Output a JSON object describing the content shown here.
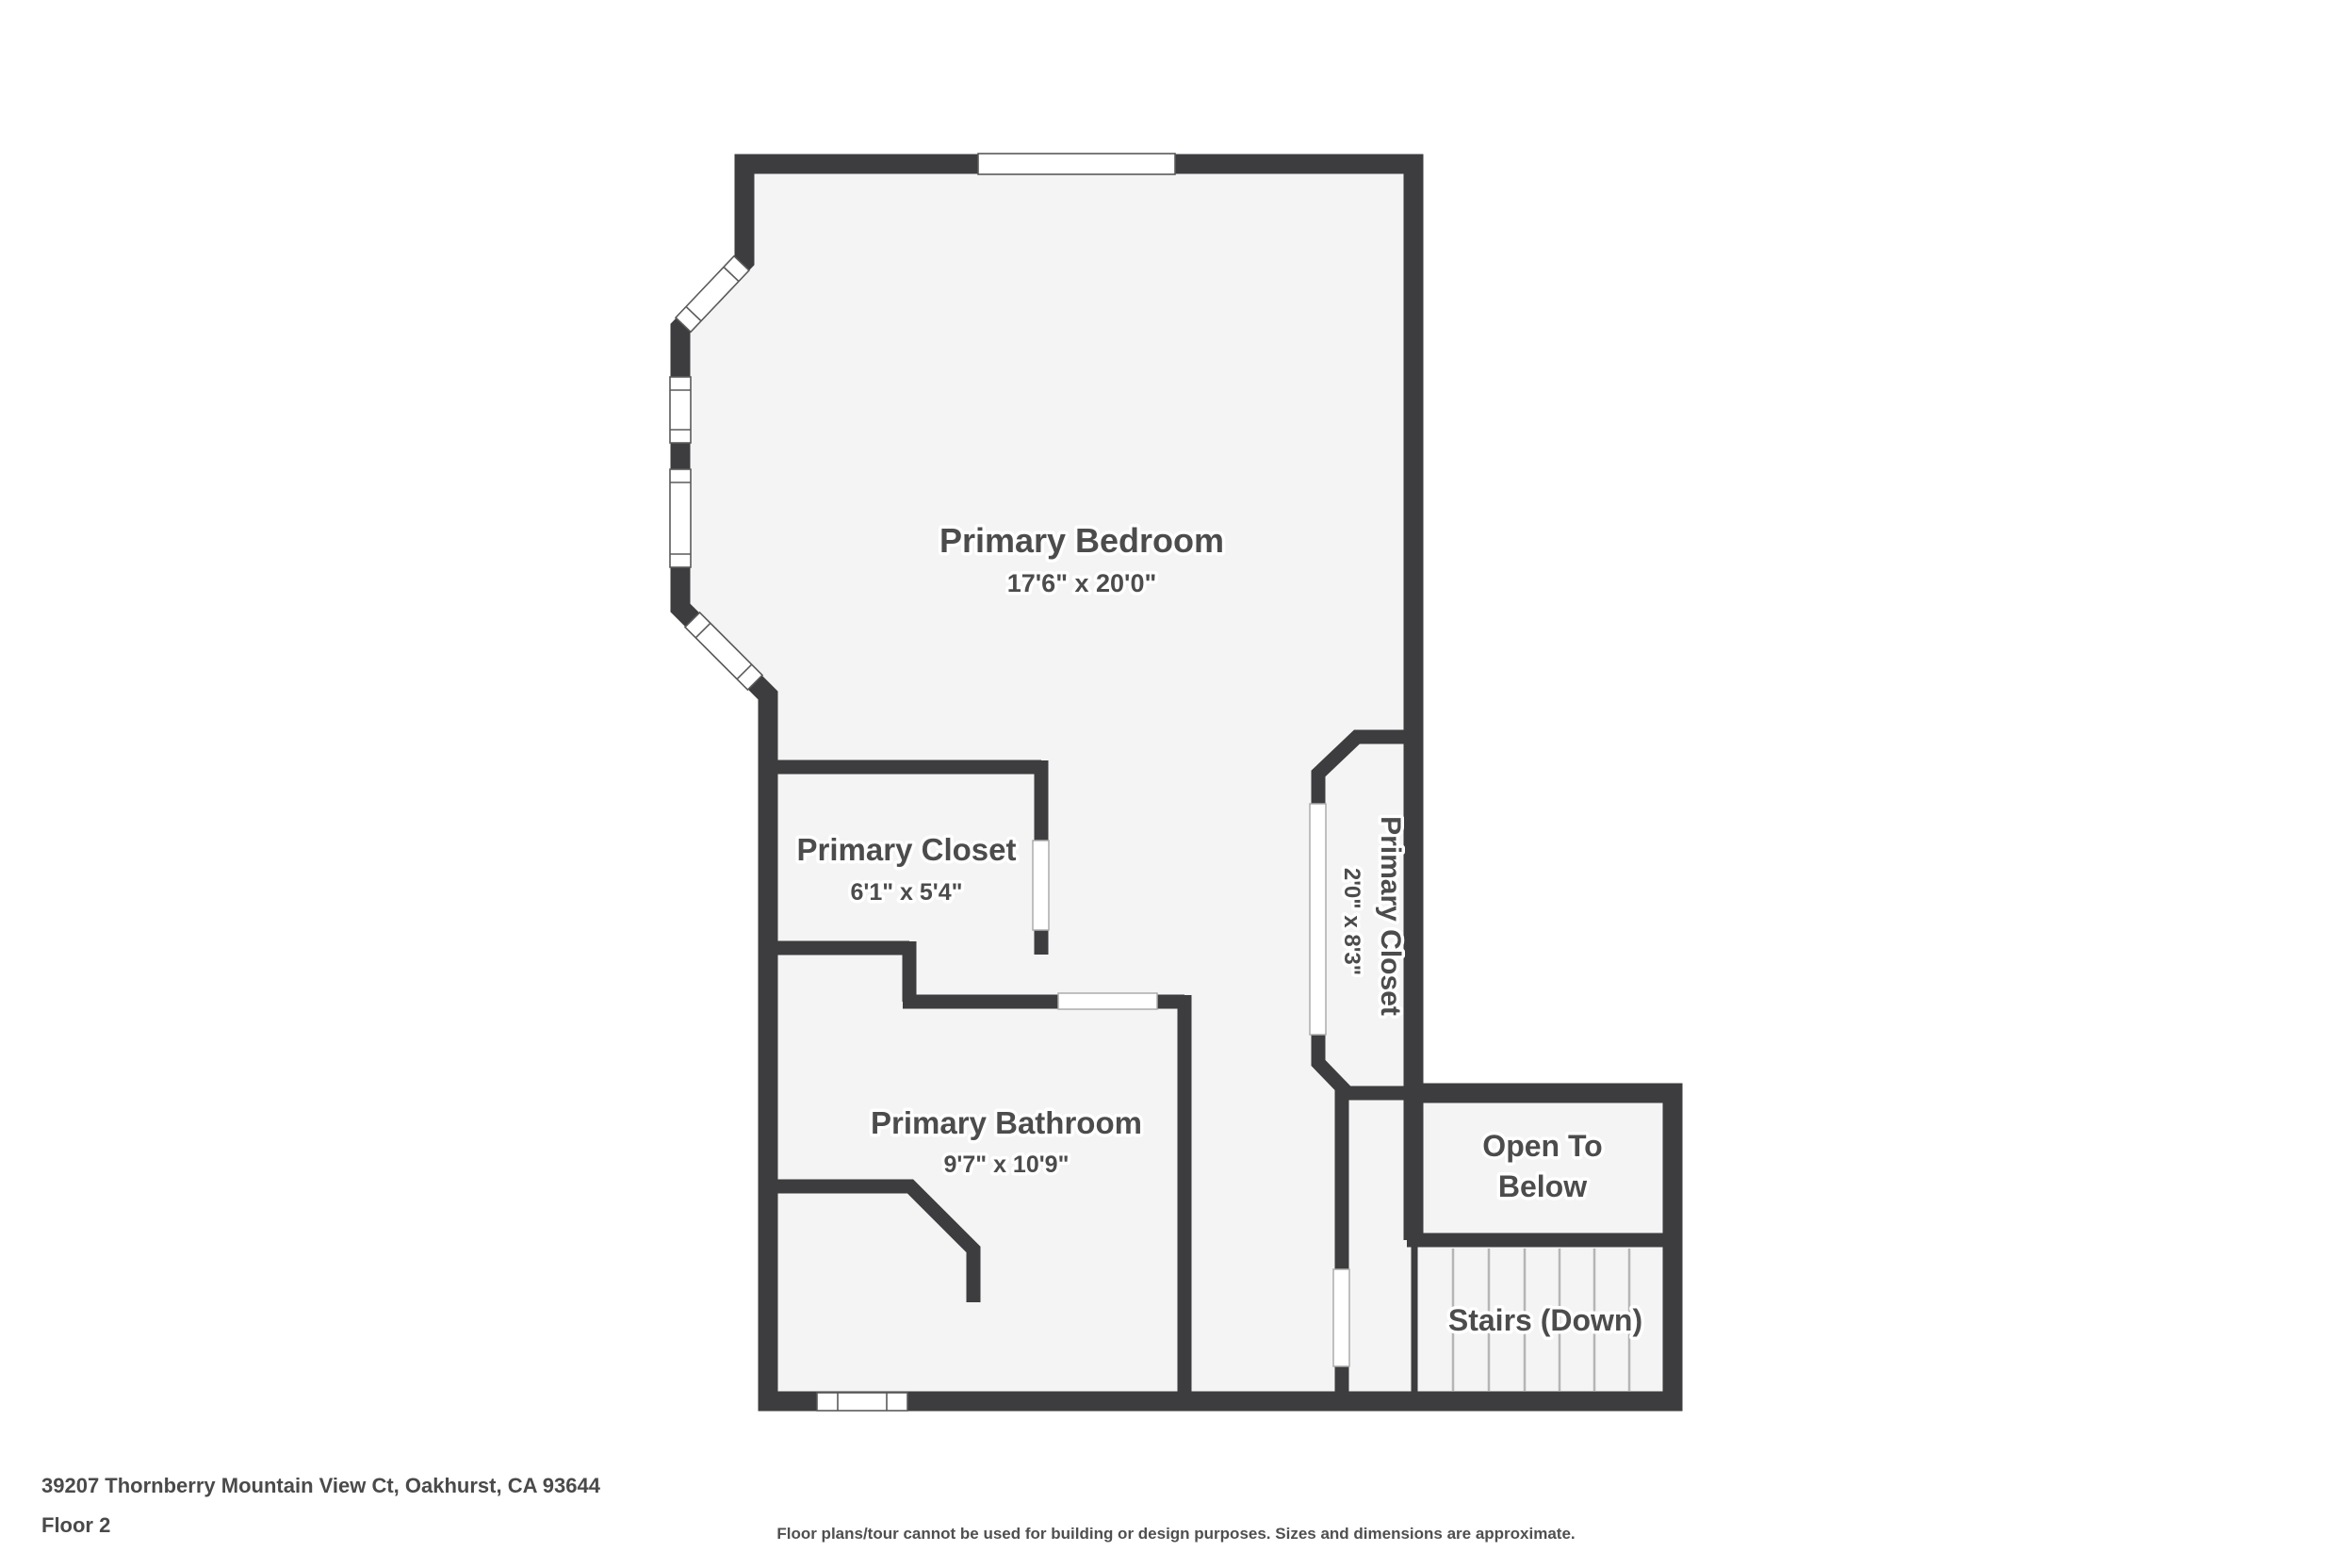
{
  "title": "Floor plan - Floor 2",
  "colors": {
    "wall": "#3d3d3f",
    "floor": "#f4f4f4",
    "tread_line": "#b5b5b5",
    "label_text": "#4c4c4c",
    "footer_text": "#4a4a4a",
    "background": "#ffffff"
  },
  "rooms": {
    "bedroom": {
      "name": "Primary Bedroom",
      "dims": "17'6\" x 20'0\""
    },
    "closet_left": {
      "name": "Primary Closet",
      "dims": "6'1\" x 5'4\""
    },
    "closet_right": {
      "name": "Primary Closet",
      "dims": "2'0\" x 8'3\""
    },
    "bathroom": {
      "name": "Primary Bathroom",
      "dims": "9'7\" x 10'9\""
    },
    "open_to_below": {
      "line1": "Open To",
      "line2": "Below"
    },
    "stairs": {
      "name": "Stairs (Down)"
    }
  },
  "footer": {
    "address": "39207 Thornberry Mountain View Ct, Oakhurst, CA 93644",
    "floor": "Floor 2",
    "disclaimer": "Floor plans/tour cannot be used for building or design purposes. Sizes and dimensions are approximate."
  }
}
